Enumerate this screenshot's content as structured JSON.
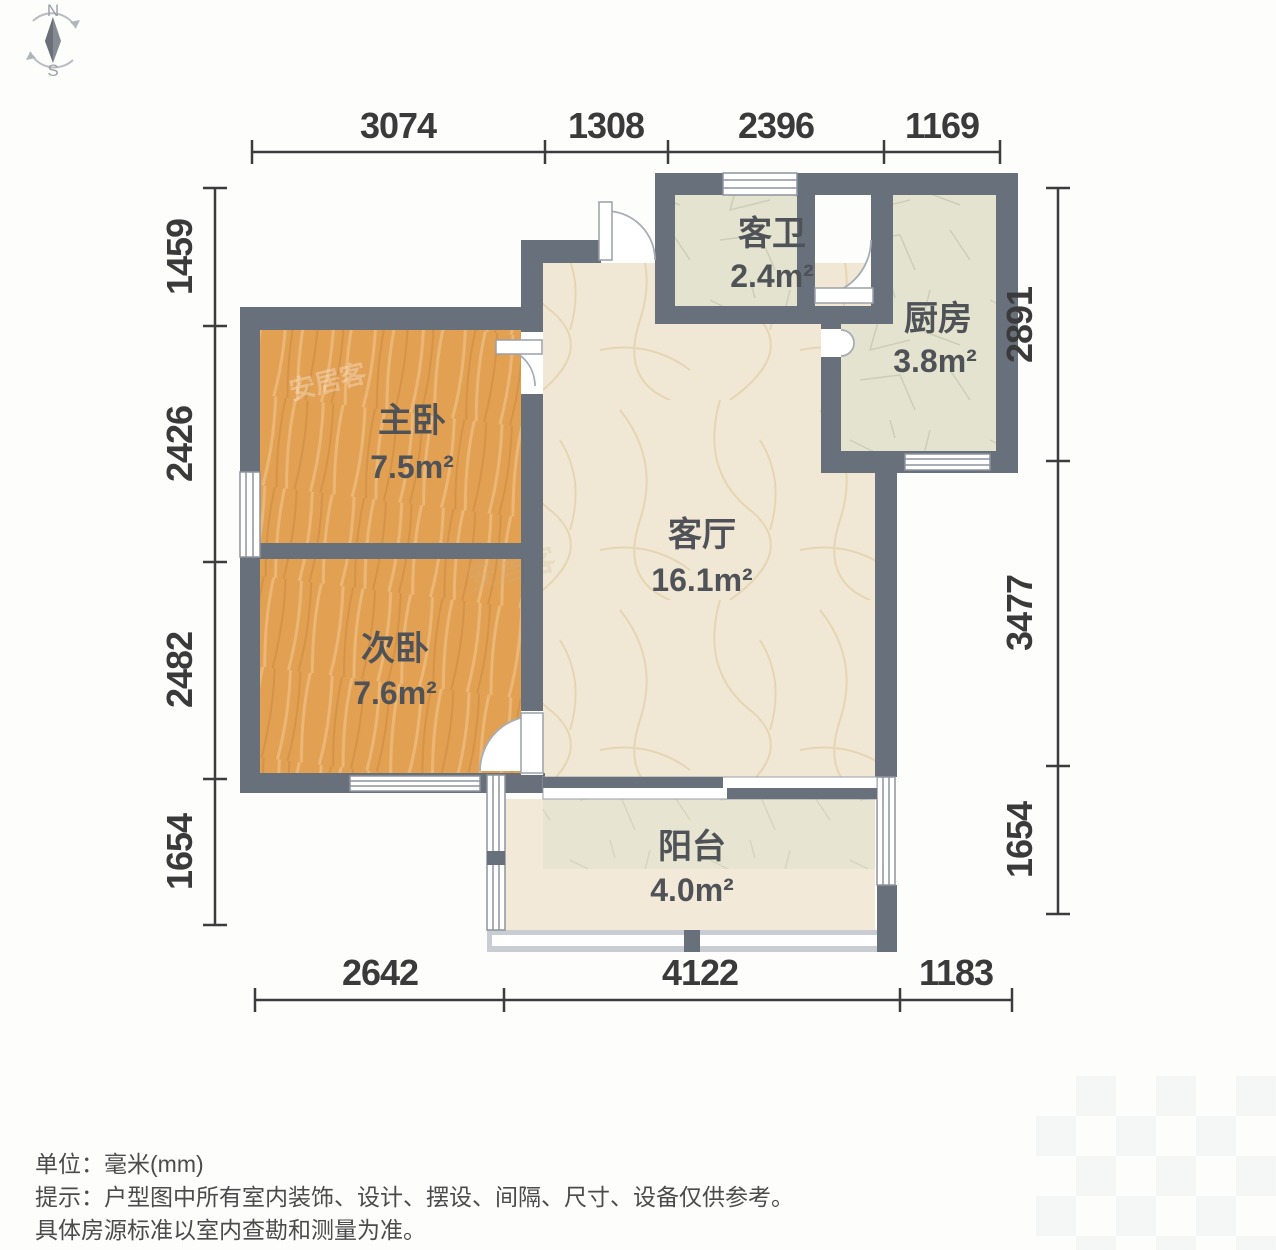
{
  "compass": {
    "north": "N",
    "south": "S"
  },
  "rooms": [
    {
      "id": "master-bedroom",
      "name": "主卧",
      "area": "7.5m²"
    },
    {
      "id": "second-bedroom",
      "name": "次卧",
      "area": "7.6m²"
    },
    {
      "id": "living-room",
      "name": "客厅",
      "area": "16.1m²"
    },
    {
      "id": "guest-bathroom",
      "name": "客卫",
      "area": "2.4m²"
    },
    {
      "id": "kitchen",
      "name": "厨房",
      "area": "3.8m²"
    },
    {
      "id": "balcony",
      "name": "阳台",
      "area": "4.0m²"
    }
  ],
  "dimensions_mm": {
    "top": [
      "3074",
      "1308",
      "2396",
      "1169"
    ],
    "left": [
      "1459",
      "2426",
      "2482",
      "1654"
    ],
    "right": [
      "2891",
      "3477",
      "1654"
    ],
    "bottom": [
      "2642",
      "4122",
      "1183"
    ]
  },
  "footer": {
    "unit_label": "单位：",
    "unit_value": "毫米(mm)",
    "tip_label": "提示：",
    "tip_line1": "户型图中所有室内装饰、设计、摆设、间隔、尺寸、设备仅供参考。",
    "tip_line2": "具体房源标准以室内查勘和测量为准。"
  },
  "watermark": {
    "text": "安居客"
  },
  "colors": {
    "wall": "#68707c",
    "bedroom": "#e2a053",
    "living": "#f0e8d4",
    "service": "#e3e3cf",
    "balcony": "#f2e9d8",
    "dim-text": "#3a3a3a",
    "label-text": "#4f5257"
  }
}
